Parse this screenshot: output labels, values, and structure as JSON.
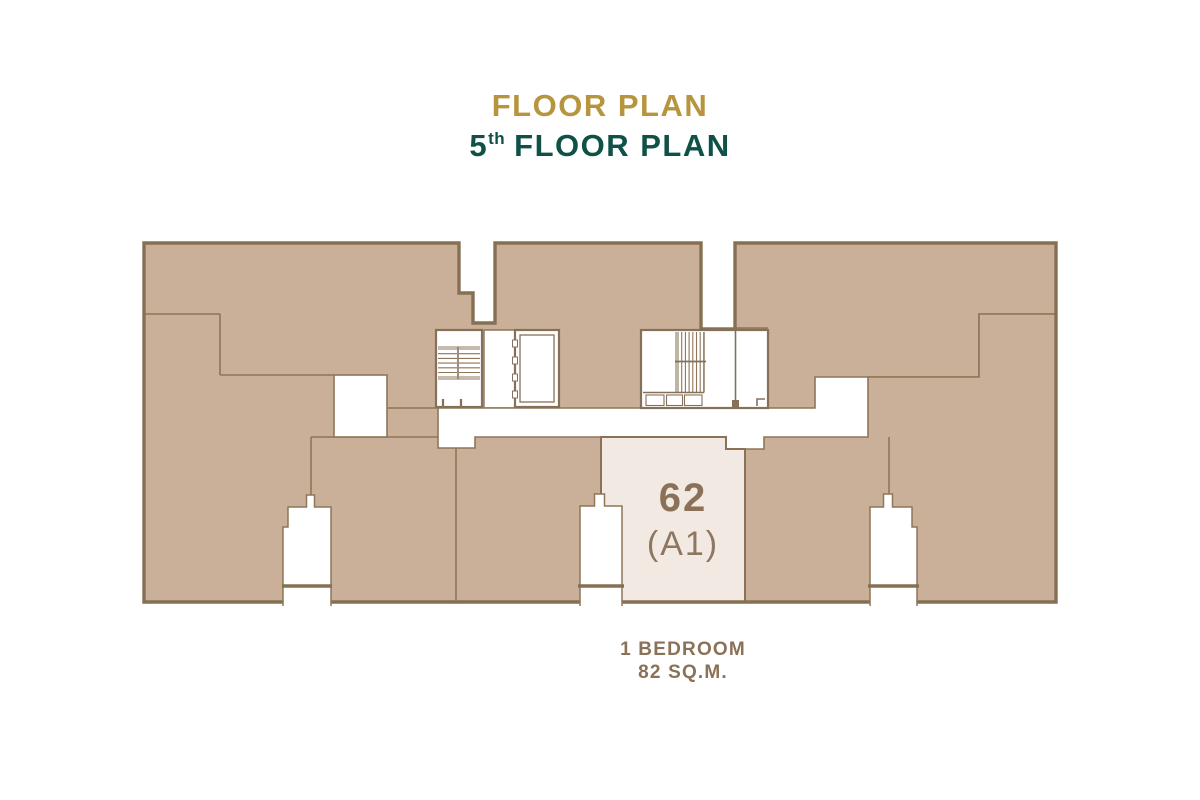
{
  "header": {
    "title": "FLOOR PLAN",
    "floor_number": "5",
    "floor_ordinal": "th",
    "floor_label": "FLOOR PLAN"
  },
  "highlighted_unit": {
    "number": "62",
    "type": "(A1)",
    "bedrooms": "1 BEDROOM",
    "area": "82 SQ.M."
  },
  "colors": {
    "title_gold": "#b6953e",
    "title_green": "#0f5047",
    "unit_fill_tan": "#cab098",
    "outline_dark": "#857053",
    "outline_thin": "#8d7659",
    "highlight_fill": "#f2e9e3",
    "label_brown": "#8a7157"
  }
}
